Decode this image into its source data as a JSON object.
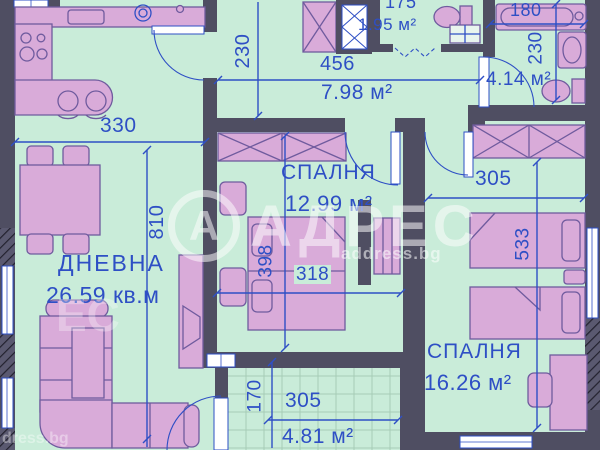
{
  "watermark": {
    "letter": "А",
    "brand": "АДРЕС",
    "site": "address.bg",
    "fragment_brand": "ЕС",
    "fragment_site": "dress.bg"
  },
  "rooms": {
    "living": {
      "name": "ДНЕВНА",
      "area": "26.59 кв.м"
    },
    "hall": {
      "area": "7.98 м²"
    },
    "wc": {
      "area": "1.95 м²"
    },
    "bath": {
      "area": "4.14 м²"
    },
    "bedroom1": {
      "name": "СПАЛНЯ",
      "area": "12.99 м²"
    },
    "bedroom2": {
      "name": "СПАЛНЯ",
      "area": "16.26 м²"
    },
    "balcony": {
      "area": "4.81 м²"
    }
  },
  "dimensions_cm": {
    "living_width": "330",
    "apartment_depth": "810",
    "hall_width": "230",
    "hall_length": "456",
    "wc_width": "175",
    "bathtub_length": "180",
    "bath_depth": "230",
    "bedroom1_width": "318",
    "bedroom1_depth": "398",
    "bedroom2_width": "305",
    "bedroom2_depth": "533",
    "balcony_width": "305",
    "balcony_depth": "170"
  },
  "colors": {
    "floor": "#c9ecd9",
    "wall": "#4f4e62",
    "furniture": "#d9abd9",
    "annotation_blue": "#2e4fc5",
    "window_white": "#ffffff"
  }
}
